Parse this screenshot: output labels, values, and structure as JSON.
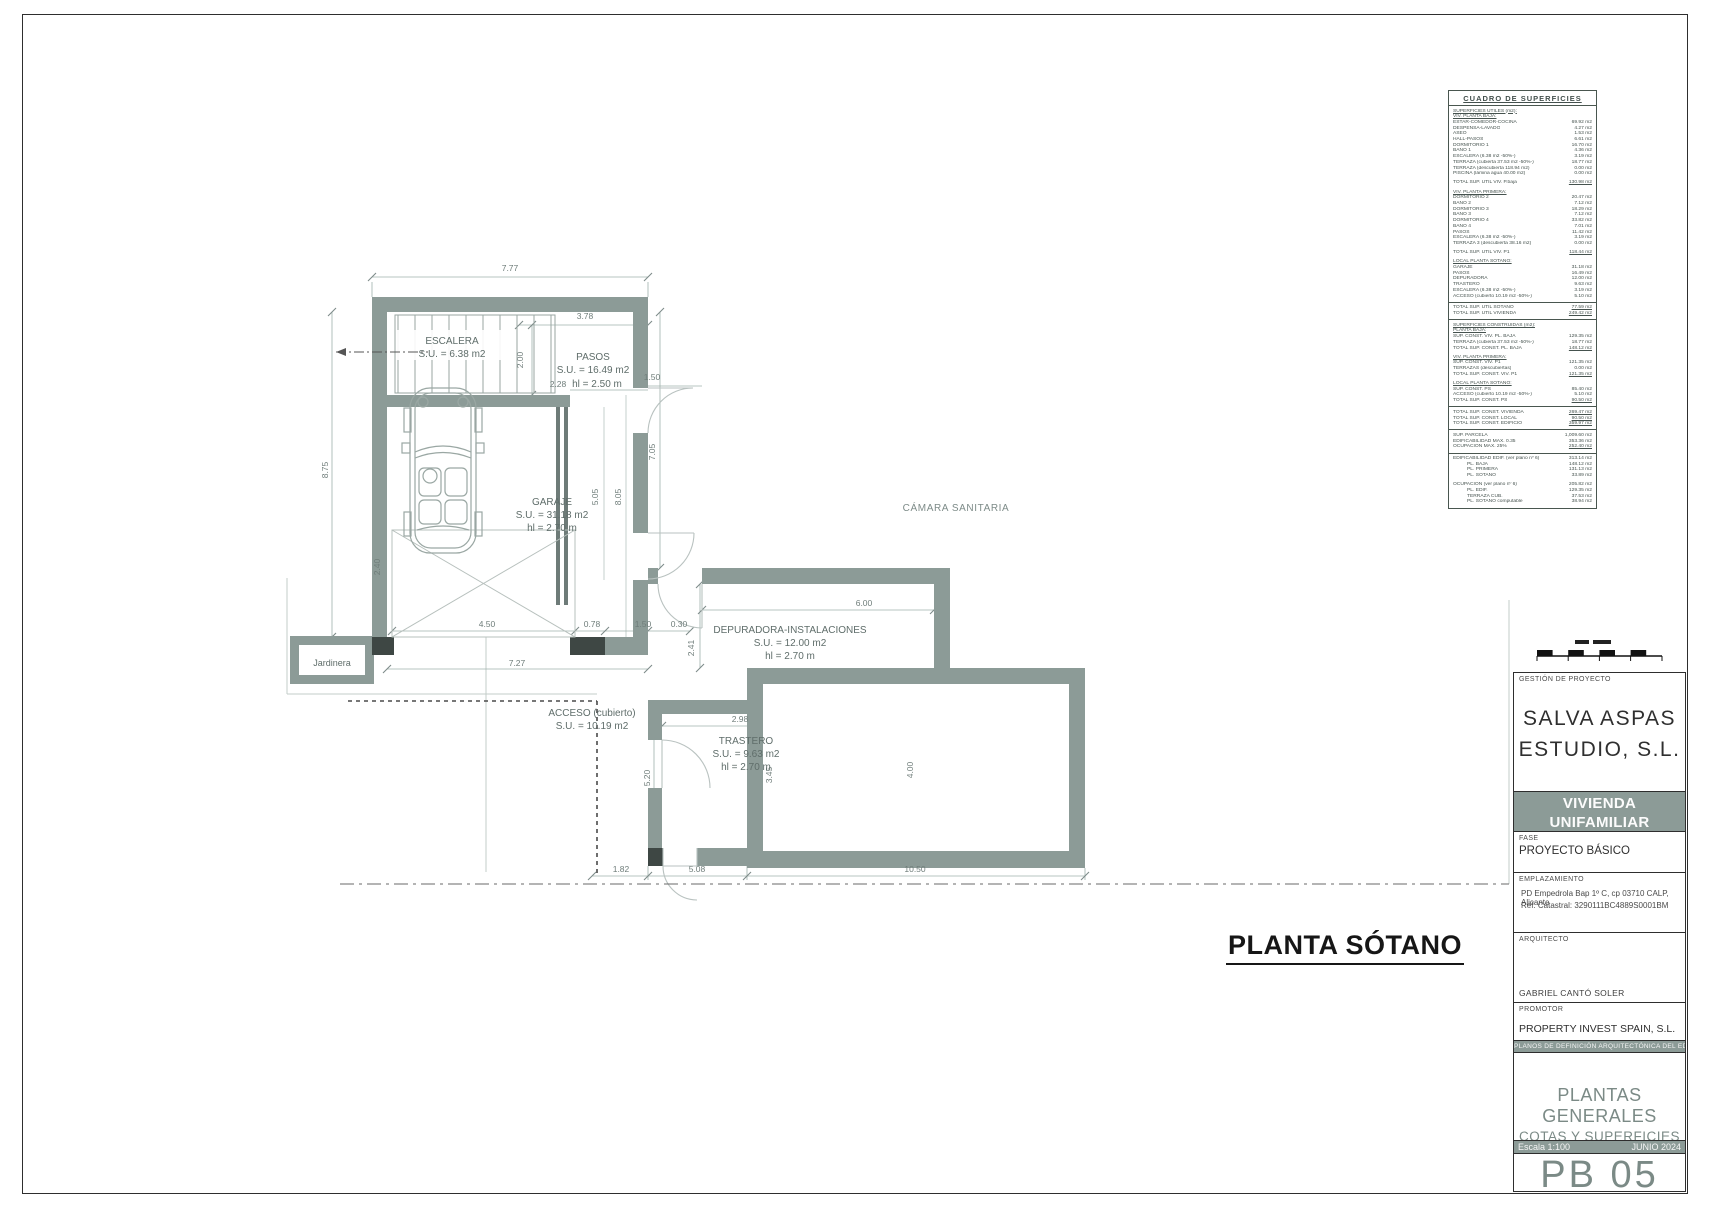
{
  "sheet": {
    "plan_title": "PLANTA SÓTANO",
    "drawing_code": "PB 05"
  },
  "colors": {
    "wall": "#8C9B97",
    "dark_section": "#3E4744",
    "dim_line": "#9FB0AB",
    "band": "#8C9B97",
    "title_text": "#161616"
  },
  "surfaces_table": {
    "title": "CUADRO DE SUPERFICIES",
    "rows": [
      {
        "t": "s",
        "l": "SUPERFICIES ÚTILES (m2):",
        "v": ""
      },
      {
        "t": "s",
        "l": "VIV. PLANTA BAJA:",
        "v": ""
      },
      {
        "t": "r",
        "l": "ESTAR-COMEDOR-COCINA",
        "v": "69.92 m2"
      },
      {
        "t": "r",
        "l": "DESPENSA-LAVADO",
        "v": "4.27 m2"
      },
      {
        "t": "r",
        "l": "ASEO",
        "v": "1.53 m2"
      },
      {
        "t": "r",
        "l": "HALL-PASOS",
        "v": "6.61 m2"
      },
      {
        "t": "r",
        "l": "DORMITORIO 1",
        "v": "16.70 m2"
      },
      {
        "t": "r",
        "l": "BAÑO 1",
        "v": "4.36 m2"
      },
      {
        "t": "r",
        "l": "ESCALERA (6.38 m2 -50%-)",
        "v": "3.19 m2"
      },
      {
        "t": "r",
        "l": "TERRAZA (cubierta 37.53 m2 -50%-)",
        "v": "18.77 m2"
      },
      {
        "t": "r",
        "l": "TERRAZA (descubierta 118.94 m2)",
        "v": "0.00 m2"
      },
      {
        "t": "r",
        "l": "PISCINA (lámina agua 40.00 m2)",
        "v": "0.00 m2"
      },
      {
        "t": "g",
        "l": "",
        "v": ""
      },
      {
        "t": "t",
        "l": "TOTAL SUP. ÚTIL VIV. P.baja",
        "v": "130.98 m2"
      },
      {
        "t": "g",
        "l": "",
        "v": ""
      },
      {
        "t": "s",
        "l": "VIV. PLANTA PRIMERA:",
        "v": ""
      },
      {
        "t": "r",
        "l": "DORMITORIO 2",
        "v": "20.47 m2"
      },
      {
        "t": "r",
        "l": "BAÑO 2",
        "v": "7.12 m2"
      },
      {
        "t": "r",
        "l": "DORMITORIO 3",
        "v": "18.29 m2"
      },
      {
        "t": "r",
        "l": "BAÑO 3",
        "v": "7.12 m2"
      },
      {
        "t": "r",
        "l": "DORMITORIO 4",
        "v": "33.82 m2"
      },
      {
        "t": "r",
        "l": "BAÑO 4",
        "v": "7.01 m2"
      },
      {
        "t": "r",
        "l": "PASOS",
        "v": "11.42 m2"
      },
      {
        "t": "r",
        "l": "ESCALERA (6.38 m2 -50%-)",
        "v": "3.19 m2"
      },
      {
        "t": "r",
        "l": "TERRAZA 3 (descubierta 38.16 m2)",
        "v": "0.00 m2"
      },
      {
        "t": "g",
        "l": "",
        "v": ""
      },
      {
        "t": "t",
        "l": "TOTAL SUP. ÚTIL VIV. P1",
        "v": "118.44 m2"
      },
      {
        "t": "g",
        "l": "",
        "v": ""
      },
      {
        "t": "s",
        "l": "LOCAL PLANTA SÓTANO:",
        "v": ""
      },
      {
        "t": "r",
        "l": "GARAJE",
        "v": "31.18 m2"
      },
      {
        "t": "r",
        "l": "PASOS",
        "v": "16.49 m2"
      },
      {
        "t": "r",
        "l": "DEPURADORA",
        "v": "12.00 m2"
      },
      {
        "t": "r",
        "l": "TRASTERO",
        "v": "9.63 m2"
      },
      {
        "t": "r",
        "l": "ESCALERA (6.38 m2 -50%-)",
        "v": "3.19 m2"
      },
      {
        "t": "r",
        "l": "ACCESO (cubierto 10.19 m2 -50%-)",
        "v": "5.10 m2"
      },
      {
        "t": "d",
        "l": "",
        "v": ""
      },
      {
        "t": "t",
        "l": "TOTAL SUP. ÚTIL SÓTANO",
        "v": "77.59 m2"
      },
      {
        "t": "t",
        "l": "TOTAL SUP. ÚTIL VIVIENDA",
        "v": "249.42 m2"
      },
      {
        "t": "d",
        "l": "",
        "v": ""
      },
      {
        "t": "s",
        "l": "SUPERFICIES CONSTRUIDAS (m2):",
        "v": ""
      },
      {
        "t": "s",
        "l": "PLANTA BAJA:",
        "v": ""
      },
      {
        "t": "r",
        "l": "SUP. CONST. VIV. PL. BAJA",
        "v": "129.35 m2"
      },
      {
        "t": "r",
        "l": "TERRAZA (cubierta 37.53 m2 -50%-)",
        "v": "18.77 m2"
      },
      {
        "t": "t",
        "l": "TOTAL SUP. CONST. PL. BAJA",
        "v": "148.12 m2"
      },
      {
        "t": "g",
        "l": "",
        "v": ""
      },
      {
        "t": "s",
        "l": "VIV. PLANTA PRIMERA:",
        "v": ""
      },
      {
        "t": "r",
        "l": "SUP. CONST. VIV. P1",
        "v": "121.35 m2"
      },
      {
        "t": "r",
        "l": "TERRAZAS (descubiertas)",
        "v": "0.00 m2"
      },
      {
        "t": "t",
        "l": "TOTAL SUP. CONST. VIV. P1",
        "v": "121.35 m2"
      },
      {
        "t": "g",
        "l": "",
        "v": ""
      },
      {
        "t": "s",
        "l": "LOCAL PLANTA SÓTANO:",
        "v": ""
      },
      {
        "t": "r",
        "l": "SUP. CONST. PS",
        "v": "85.40 m2"
      },
      {
        "t": "r",
        "l": "ACCESO (cubierto 10.19 m2 -50%-)",
        "v": "5.10 m2"
      },
      {
        "t": "t",
        "l": "TOTAL SUP. CONST. PS",
        "v": "90.50 m2"
      },
      {
        "t": "d",
        "l": "",
        "v": ""
      },
      {
        "t": "t",
        "l": "TOTAL SUP. CONST. VIVIENDA",
        "v": "269.47 m2"
      },
      {
        "t": "t",
        "l": "TOTAL SUP. CONST. LOCAL",
        "v": "90.50 m2"
      },
      {
        "t": "t",
        "l": "TOTAL SUP. CONST. EDIFICIO",
        "v": "359.97 m2"
      },
      {
        "t": "d",
        "l": "",
        "v": ""
      },
      {
        "t": "r",
        "l": "SUP. PARCELA",
        "v": "1,009.60 m2"
      },
      {
        "t": "r",
        "l": "EDIFICABILIDAD MAX. 0.35",
        "v": "353.36 m2"
      },
      {
        "t": "t",
        "l": "OCUPACIÓN MAX. 25%",
        "v": "252.40 m2"
      },
      {
        "t": "d",
        "l": "",
        "v": ""
      },
      {
        "t": "r",
        "l": "EDIFICABILIDAD EDIF. (ver plano nº 6)",
        "v": "313.14 m2"
      },
      {
        "t": "r2",
        "l": "PL. BAJA",
        "v": "148.12 m2"
      },
      {
        "t": "r2",
        "l": "PL. PRIMERA",
        "v": "131.13 m2"
      },
      {
        "t": "r2",
        "l": "PL. SÓTANO",
        "v": "33.89 m2"
      },
      {
        "t": "g",
        "l": "",
        "v": ""
      },
      {
        "t": "r",
        "l": "OCUPACIÓN (ver plano nº 6)",
        "v": "205.82 m2"
      },
      {
        "t": "r2",
        "l": "PL. EDIF.",
        "v": "129.35 m2"
      },
      {
        "t": "r2",
        "l": "TERRAZA CUB.",
        "v": "37.53 m2"
      },
      {
        "t": "r2",
        "l": "PL. SÓTANO computable",
        "v": "38.94 m2"
      }
    ]
  },
  "plan": {
    "texts": [
      {
        "x": 510,
        "y": 271,
        "t": "7.77",
        "c": "dim"
      },
      {
        "x": 585,
        "y": 319,
        "t": "3.78",
        "c": "dim"
      },
      {
        "x": 523,
        "y": 360,
        "t": "2.00",
        "c": "dim",
        "r": -90
      },
      {
        "x": 652,
        "y": 380,
        "t": "1.50",
        "c": "dim"
      },
      {
        "x": 558,
        "y": 387,
        "t": "2.28",
        "c": "dim"
      },
      {
        "x": 328,
        "y": 470,
        "t": "8.75",
        "c": "dim",
        "r": -90
      },
      {
        "x": 655,
        "y": 452,
        "t": "7.05",
        "c": "dim",
        "r": -90
      },
      {
        "x": 621,
        "y": 497,
        "t": "8.05",
        "c": "dim",
        "r": -90
      },
      {
        "x": 598,
        "y": 497,
        "t": "5.05",
        "c": "dim",
        "r": -90
      },
      {
        "x": 380,
        "y": 567,
        "t": "2.40",
        "c": "dim",
        "r": -90
      },
      {
        "x": 487,
        "y": 627,
        "t": "4.50",
        "c": "dim"
      },
      {
        "x": 592,
        "y": 627,
        "t": "0.78",
        "c": "dim"
      },
      {
        "x": 643,
        "y": 627,
        "t": "1.50",
        "c": "dim"
      },
      {
        "x": 679,
        "y": 627,
        "t": "0.30",
        "c": "dim"
      },
      {
        "x": 517,
        "y": 666,
        "t": "7.27",
        "c": "dim"
      },
      {
        "x": 694,
        "y": 648,
        "t": "2.41",
        "c": "dim",
        "r": -90
      },
      {
        "x": 864,
        "y": 606,
        "t": "6.00",
        "c": "dim"
      },
      {
        "x": 740,
        "y": 722,
        "t": "2.98",
        "c": "dim"
      },
      {
        "x": 650,
        "y": 778,
        "t": "5.20",
        "c": "dim",
        "r": -90
      },
      {
        "x": 772,
        "y": 775,
        "t": "3.45",
        "c": "dim",
        "r": -90
      },
      {
        "x": 913,
        "y": 770,
        "t": "4.00",
        "c": "dim",
        "r": -90
      },
      {
        "x": 621,
        "y": 872,
        "t": "1.82",
        "c": "dim"
      },
      {
        "x": 697,
        "y": 872,
        "t": "5.08",
        "c": "dim"
      },
      {
        "x": 915,
        "y": 872,
        "t": "10.50",
        "c": "dim"
      },
      {
        "x": 452,
        "y": 344,
        "t": "ESCALERA",
        "c": "room"
      },
      {
        "x": 452,
        "y": 357,
        "t": "S.U. = 6.38 m2",
        "c": "room"
      },
      {
        "x": 593,
        "y": 360,
        "t": "PASOS",
        "c": "room"
      },
      {
        "x": 593,
        "y": 373,
        "t": "S.U. = 16.49 m2",
        "c": "room"
      },
      {
        "x": 597,
        "y": 387,
        "t": "hl = 2.50 m",
        "c": "room"
      },
      {
        "x": 552,
        "y": 505,
        "t": "GARAJE",
        "c": "room"
      },
      {
        "x": 552,
        "y": 518,
        "t": "S.U. = 31.18 m2",
        "c": "room"
      },
      {
        "x": 552,
        "y": 531,
        "t": "hl = 2.70 m",
        "c": "room"
      },
      {
        "x": 956,
        "y": 511,
        "t": "CÁMARA SANITARIA",
        "c": "cam"
      },
      {
        "x": 790,
        "y": 633,
        "t": "DEPURADORA-INSTALACIONES",
        "c": "room"
      },
      {
        "x": 790,
        "y": 646,
        "t": "S.U. = 12.00 m2",
        "c": "room"
      },
      {
        "x": 790,
        "y": 659,
        "t": "hl = 2.70 m",
        "c": "room"
      },
      {
        "x": 746,
        "y": 744,
        "t": "TRASTERO",
        "c": "room"
      },
      {
        "x": 746,
        "y": 757,
        "t": "S.U. = 9.63 m2",
        "c": "room"
      },
      {
        "x": 746,
        "y": 770,
        "t": "hl = 2.70 m",
        "c": "room"
      },
      {
        "x": 592,
        "y": 716,
        "t": "ACCESO (cubierto)",
        "c": "room"
      },
      {
        "x": 592,
        "y": 729,
        "t": "S.U. = 10.19 m2",
        "c": "room"
      },
      {
        "x": 332,
        "y": 666,
        "t": "Jardinera",
        "c": "jard"
      }
    ]
  },
  "titleblock": {
    "project_management_label": "GESTIÓN DE PROYECTO",
    "studio_line1": "SALVA ASPAS",
    "studio_line2": "ESTUDIO, S.L.",
    "project_line1": "VIVIENDA UNIFAMILIAR",
    "project_line2": "AISLADA CON PISCINA",
    "fase_label": "FASE",
    "fase_value": "PROYECTO BÁSICO",
    "emplazamiento_label": "EMPLAZAMIENTO",
    "address_line1": "PD Empedrola Bap 1º C, cp 03710 CALP, Alicante",
    "address_line2": "Ref. Catastral: 3290111BC4889S0001BM",
    "arquitecto_label": "ARQUITECTO",
    "arquitecto_value": "GABRIEL CANTÓ SOLER",
    "promotor_label": "PROMOTOR",
    "promotor_value": "PROPERTY INVEST SPAIN, S.L.",
    "band_text": "PLANOS DE DEFINICIÓN ARQUITECTÓNICA DEL EDIFICIO",
    "sheet_name_line1": "PLANTAS GENERALES",
    "sheet_name_line2": "COTAS Y SUPERFICIES",
    "scale_label": "Escala 1:100",
    "date_label": "JUNIO 2024"
  }
}
